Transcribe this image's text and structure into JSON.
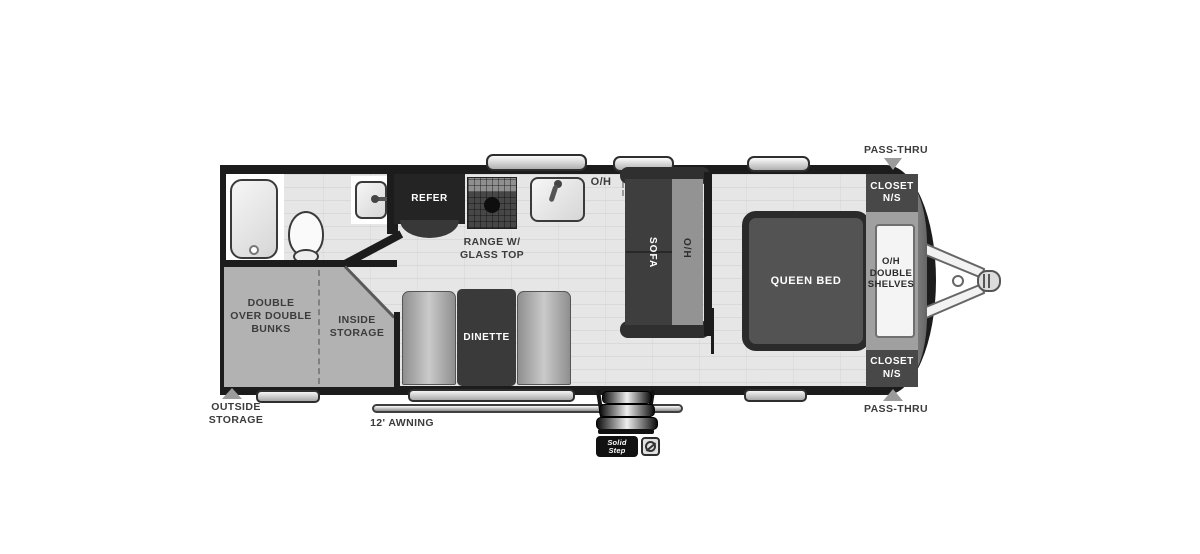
{
  "labels": {
    "pass_thru_top": "PASS-THRU",
    "pass_thru_bottom": "PASS-THRU",
    "closet_front_top": "CLOSET\nN/S",
    "closet_front_bottom": "CLOSET\nN/S",
    "oh_double_shelves": "O/H\nDOUBLE\nSHELVES",
    "queen_bed": "QUEEN BED",
    "sofa": "SOFA",
    "oh_sofa": "O/H",
    "oh_kitchen": "O/H",
    "refer": "REFER",
    "range": "RANGE W/\nGLASS TOP",
    "dinette": "DINETTE",
    "bunks": "DOUBLE\nOVER DOUBLE\nBUNKS",
    "inside_storage": "INSIDE\nSTORAGE",
    "outside_storage": "OUTSIDE\nSTORAGE",
    "awning": "12' AWNING",
    "solid_step_badge": "Solid\nStep"
  },
  "icons": {
    "pass_thru_arrows": "gray-triangle",
    "outside_storage_arrow": "gray-triangle",
    "hitch": "a-frame-tongue-with-coupler",
    "entry_steps": "triple-fold-steps",
    "certification_badge": "circle-swirl"
  },
  "colors": {
    "wall": "#1c1c1c",
    "floor": "#e6e6e6",
    "storage_gray": "#b2b2b2",
    "furniture_dark": "#3e3e3e",
    "bed_fill": "#535353",
    "label_text": "#3c3c3c",
    "white_text": "#ffffff"
  }
}
